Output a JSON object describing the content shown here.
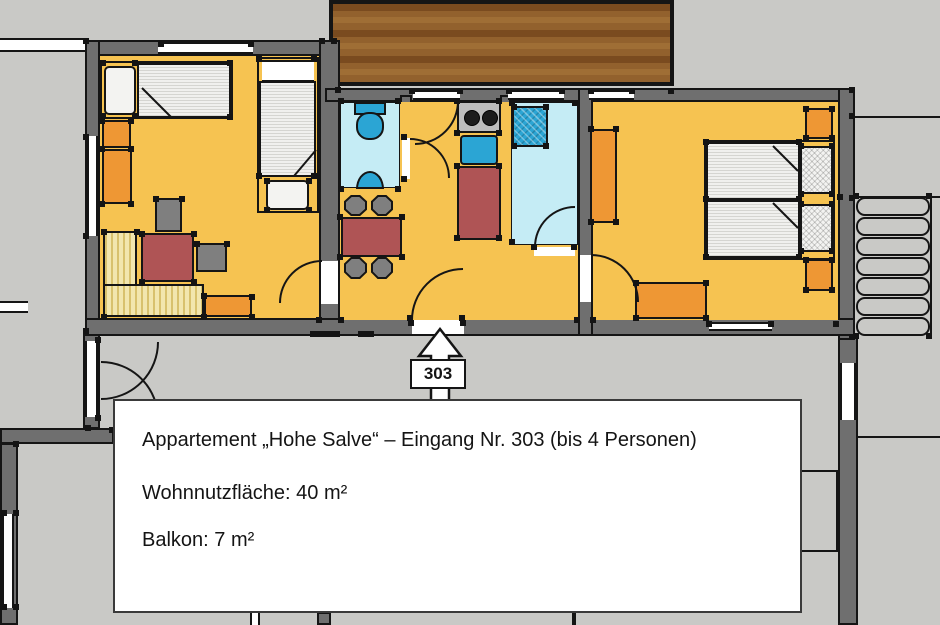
{
  "entrance": {
    "number": "303"
  },
  "info_box": {
    "title": "Appartement „Hohe Salve“ – Eingang Nr. 303 (bis 4 Personen)",
    "living_area": "Wohnnutzfläche: 40 m²",
    "balcony_area": "Balkon: 7 m²"
  },
  "colors": {
    "background": "#C9C9C6",
    "wall": "#6F6F6F",
    "floor": "#F6C351",
    "wet_floor": "#C5ECF5",
    "fixture_blue": "#2BA5D4",
    "furniture_orange": "#EE9734",
    "table_red": "#AF5455",
    "chair_gray": "#7F7F7F",
    "wood_dark": "#7A4B1F",
    "wood_mid": "#92612D",
    "wood_light": "#9F6E35"
  }
}
